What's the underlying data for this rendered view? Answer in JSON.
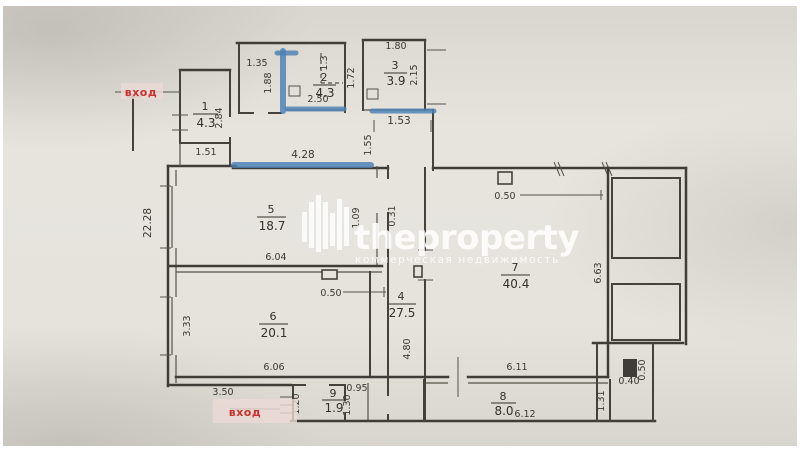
{
  "watermark": {
    "brand": "theproperty",
    "subtitle": "коммерческая недвижимость"
  },
  "entrance": {
    "top": "вход",
    "bottom": "вход"
  },
  "rooms": [
    {
      "n": "1",
      "a": "4.3"
    },
    {
      "n": "2",
      "a": "4.3"
    },
    {
      "n": "3",
      "a": "3.9"
    },
    {
      "n": "4",
      "a": "27.5"
    },
    {
      "n": "5",
      "a": "18.7"
    },
    {
      "n": "6",
      "a": "20.1"
    },
    {
      "n": "7",
      "a": "40.4"
    },
    {
      "n": "8",
      "a": "8.0"
    },
    {
      "n": "9",
      "a": "1.9"
    }
  ],
  "dims": [
    "1.35",
    "1.88",
    "1.3",
    "2.50",
    "1.72",
    "1.80",
    "2.15",
    "1.53",
    "1.55",
    "1.51",
    "2.84",
    "22.28",
    "4.28",
    "1.09",
    "0.31",
    "6.04",
    "0.50",
    "0.50",
    "3.33",
    "6.06",
    "3.50",
    "4.80",
    "6.63",
    "6.11",
    "6.12",
    "1.31",
    "0.40",
    "0.50",
    "0.95",
    "1.20",
    "1.30"
  ],
  "colors": {
    "wall": "#403d38",
    "highlight_blue": "#4a80b4",
    "entrance_red": "#c63232",
    "paper": "#e6e3dd"
  }
}
